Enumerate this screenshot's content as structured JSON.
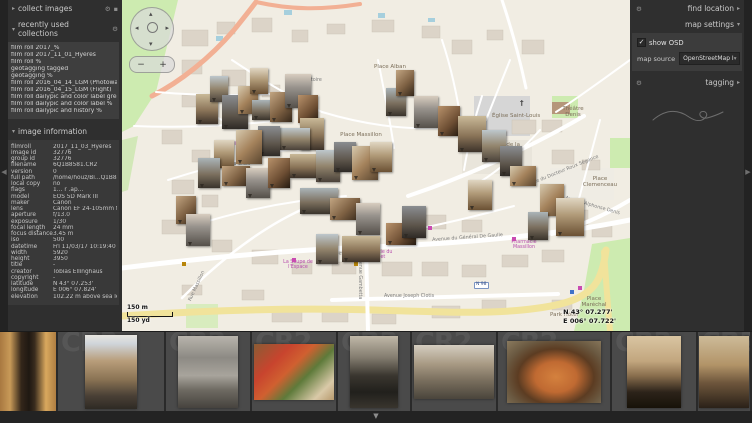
{
  "icons": {
    "gear": "⚙",
    "menu_square": "▪",
    "expander_collapsed": "▸",
    "expander_expanded": "▾",
    "collapse_left": "◀",
    "collapse_right": "▶",
    "collapse_bottom": "▼",
    "checkbox_check": "✓",
    "dropdown_arrow": "▾",
    "pan_up": "▴",
    "pan_down": "▾",
    "pan_left": "◂",
    "pan_right": "▸",
    "church_cross": "†"
  },
  "left_panel": {
    "collect_images": {
      "title": "collect images"
    },
    "recently_used_collections": {
      "title": "recently used collections",
      "items": [
        "film roll 2017_%",
        "film roll 2017_11_01_Hyères",
        "film roll %",
        "geotagging tagged",
        "geotagging %",
        "film roll 2016_04_14_LGM (Photowalk)",
        "film roll 2016_04_15_LGM (Flight)",
        "film roll dailypic and color label green",
        "film roll dailypic and color label %",
        "film roll dailypic and history %"
      ]
    },
    "image_information": {
      "title": "image information",
      "rows": [
        {
          "label": "filmroll",
          "value": "2017_11_03_Hyères"
        },
        {
          "label": "image id",
          "value": "32776"
        },
        {
          "label": "group id",
          "value": "32776"
        },
        {
          "label": "filename",
          "value": "6Q1B8581.CR2"
        },
        {
          "label": "version",
          "value": "0"
        },
        {
          "label": "full path",
          "value": "/home/houz/Bi…Q1B8581.CR2"
        },
        {
          "label": "local copy",
          "value": "no"
        },
        {
          "label": "flags",
          "value": "1… r .ap…"
        },
        {
          "label": "model",
          "value": "EOS 5D Mark III"
        },
        {
          "label": "maker",
          "value": "Canon"
        },
        {
          "label": "lens",
          "value": "Canon EF 24-105mm f/4L IS"
        },
        {
          "label": "aperture",
          "value": "f/13.0"
        },
        {
          "label": "exposure",
          "value": "1/30"
        },
        {
          "label": "focal length",
          "value": "24 mm"
        },
        {
          "label": "focus distance",
          "value": "3.45 m"
        },
        {
          "label": "iso",
          "value": "500"
        },
        {
          "label": "datetime",
          "value": "Fri 11/03/17 10:19:40"
        },
        {
          "label": "width",
          "value": "5920"
        },
        {
          "label": "height",
          "value": "3950"
        },
        {
          "label": "title",
          "value": "-"
        },
        {
          "label": "creator",
          "value": "Tobias Ellinghaus"
        },
        {
          "label": "copyright",
          "value": "-"
        },
        {
          "label": "latitude",
          "value": "N 43° 07.253'"
        },
        {
          "label": "longitude",
          "value": "E 006° 07.824'"
        },
        {
          "label": "elevation",
          "value": "102.22 m above sea level"
        }
      ]
    }
  },
  "right_panel": {
    "find_location": {
      "title": "find location"
    },
    "map_settings": {
      "title": "map settings",
      "show_osd": {
        "label": "show OSD",
        "checked": true
      },
      "map_source": {
        "label": "map source",
        "value": "OpenStreetMap I"
      }
    },
    "tagging": {
      "title": "tagging"
    }
  },
  "map": {
    "osd": {
      "scale_metric": "150 m",
      "scale_imperial": "150 yd",
      "coord_lat": "N 43° 07.277'",
      "coord_lon": "E 006° 07.722'",
      "zoom_in": "+",
      "zoom_out": "−"
    },
    "labels": [
      {
        "text": "Place Alban",
        "x": 252,
        "y": 64,
        "cls": "place"
      },
      {
        "text": "de l'Oratoire",
        "x": 170,
        "y": 78,
        "cls": "street"
      },
      {
        "text": "†",
        "x": 398,
        "y": 100,
        "cls": "church"
      },
      {
        "text": "Église Saint-Louis",
        "x": 370,
        "y": 113,
        "cls": "place"
      },
      {
        "text": "Théâtre Denis",
        "x": 434,
        "y": 106,
        "cls": "place",
        "w": 34
      },
      {
        "text": "Place de la République",
        "x": 352,
        "y": 142,
        "cls": "place",
        "w": 62
      },
      {
        "text": "Rue du Docteur Roux Ségonce",
        "x": 408,
        "y": 182,
        "cls": "street",
        "rot": -22
      },
      {
        "text": "Place Massillon",
        "x": 218,
        "y": 132,
        "cls": "place",
        "w": 42
      },
      {
        "text": "Église Saint-Paul",
        "x": 104,
        "y": 142,
        "cls": "poi",
        "w": 42
      },
      {
        "text": "Rue de la Croix",
        "x": 92,
        "y": 162,
        "cls": "street"
      },
      {
        "text": "Place Clemenceau",
        "x": 454,
        "y": 176,
        "cls": "place",
        "w": 48
      },
      {
        "text": "Avenue Alphonse Denis",
        "x": 444,
        "y": 196,
        "cls": "street",
        "rot": 16
      },
      {
        "text": "Avenue du Général De Gaulle",
        "x": 310,
        "y": 238,
        "cls": "street",
        "rot": -4
      },
      {
        "text": "Avenue des Îles d'Or",
        "x": 194,
        "y": 254,
        "cls": "street",
        "rot": -6
      },
      {
        "text": "Pharmacie du Portalet",
        "x": 234,
        "y": 250,
        "cls": "poi",
        "w": 40
      },
      {
        "text": "Pharmacie Massillon",
        "x": 382,
        "y": 240,
        "cls": "poi",
        "w": 40
      },
      {
        "text": "La Soupe de l'Espace",
        "x": 156,
        "y": 260,
        "cls": "poi",
        "w": 40
      },
      {
        "text": "Avenue Gambetta",
        "x": 240,
        "y": 256,
        "cls": "street",
        "rot": 90
      },
      {
        "text": "Avenue Joseph Clotis",
        "x": 262,
        "y": 294,
        "cls": "street"
      },
      {
        "text": "N 98",
        "x": 352,
        "y": 282,
        "cls": "badge"
      },
      {
        "text": "Place Maréchal",
        "x": 452,
        "y": 296,
        "cls": "place",
        "w": 40
      },
      {
        "text": "Park Hôtel",
        "x": 428,
        "y": 312,
        "cls": "place"
      },
      {
        "text": "Rue Massillon",
        "x": 66,
        "y": 300,
        "cls": "street",
        "rot": -65
      }
    ],
    "photos": [
      [
        74,
        94,
        22,
        30,
        0
      ],
      [
        88,
        76,
        18,
        26,
        1
      ],
      [
        100,
        95,
        26,
        34,
        2
      ],
      [
        116,
        86,
        20,
        28,
        3
      ],
      [
        128,
        68,
        18,
        26,
        4
      ],
      [
        130,
        100,
        28,
        20,
        5
      ],
      [
        148,
        92,
        22,
        30,
        6
      ],
      [
        163,
        74,
        26,
        34,
        7
      ],
      [
        176,
        95,
        20,
        28,
        8
      ],
      [
        178,
        118,
        24,
        32,
        0
      ],
      [
        158,
        128,
        30,
        22,
        1
      ],
      [
        136,
        126,
        22,
        30,
        2
      ],
      [
        114,
        130,
        26,
        34,
        3
      ],
      [
        92,
        140,
        20,
        28,
        4
      ],
      [
        76,
        158,
        22,
        30,
        5
      ],
      [
        100,
        166,
        28,
        20,
        6
      ],
      [
        124,
        168,
        24,
        30,
        7
      ],
      [
        146,
        158,
        22,
        30,
        8
      ],
      [
        168,
        154,
        32,
        24,
        0
      ],
      [
        194,
        150,
        24,
        32,
        1
      ],
      [
        212,
        142,
        22,
        30,
        2
      ],
      [
        230,
        146,
        26,
        34,
        3
      ],
      [
        248,
        142,
        22,
        30,
        4
      ],
      [
        264,
        88,
        20,
        28,
        5
      ],
      [
        274,
        70,
        18,
        26,
        6
      ],
      [
        292,
        96,
        24,
        32,
        7
      ],
      [
        316,
        106,
        22,
        30,
        8
      ],
      [
        336,
        116,
        28,
        36,
        0
      ],
      [
        360,
        130,
        24,
        32,
        1
      ],
      [
        378,
        146,
        22,
        30,
        2
      ],
      [
        388,
        166,
        26,
        20,
        3
      ],
      [
        346,
        180,
        24,
        30,
        4
      ],
      [
        178,
        188,
        38,
        26,
        5
      ],
      [
        208,
        198,
        30,
        22,
        6
      ],
      [
        234,
        203,
        24,
        32,
        7
      ],
      [
        264,
        223,
        30,
        22,
        8
      ],
      [
        220,
        236,
        38,
        26,
        0
      ],
      [
        194,
        234,
        22,
        30,
        1
      ],
      [
        280,
        206,
        24,
        32,
        2
      ],
      [
        418,
        184,
        24,
        32,
        3
      ],
      [
        434,
        198,
        28,
        38,
        4
      ],
      [
        406,
        212,
        20,
        28,
        5
      ],
      [
        54,
        196,
        20,
        28,
        6
      ],
      [
        64,
        214,
        24,
        32,
        7
      ]
    ],
    "pois": [
      [
        244,
        246,
        "#c94bb1"
      ],
      [
        390,
        237,
        "#c94bb1"
      ],
      [
        170,
        258,
        "#c94bb1"
      ],
      [
        306,
        226,
        "#c94bb1"
      ],
      [
        282,
        228,
        "#c94bb1"
      ],
      [
        456,
        286,
        "#c94bb1"
      ],
      [
        60,
        262,
        "#b8860b"
      ],
      [
        206,
        256,
        "#b8860b"
      ],
      [
        232,
        262,
        "#b8860b"
      ],
      [
        448,
        290,
        "#3f72c9"
      ]
    ]
  },
  "filmstrip": {
    "ghost_label": "CR2",
    "cells": [
      {
        "w": 58,
        "selected": true,
        "img": "alley",
        "iw": 56,
        "ih": 79
      },
      {
        "w": 108,
        "selected": false,
        "img": "street",
        "iw": 52,
        "ih": 74
      },
      {
        "w": 86,
        "selected": false,
        "img": "wet",
        "iw": 60,
        "ih": 72
      },
      {
        "w": 86,
        "selected": false,
        "img": "market",
        "iw": 80,
        "ih": 56
      },
      {
        "w": 74,
        "selected": false,
        "img": "chalk",
        "iw": 48,
        "ih": 72
      },
      {
        "w": 86,
        "selected": false,
        "img": "street2",
        "iw": 80,
        "ih": 54
      },
      {
        "w": 114,
        "selected": false,
        "img": "basket",
        "iw": 94,
        "ih": 62
      },
      {
        "w": 86,
        "selected": false,
        "img": "arch1",
        "iw": 54,
        "ih": 72
      },
      {
        "w": 54,
        "selected": false,
        "img": "arch2",
        "iw": 50,
        "ih": 72
      }
    ]
  }
}
